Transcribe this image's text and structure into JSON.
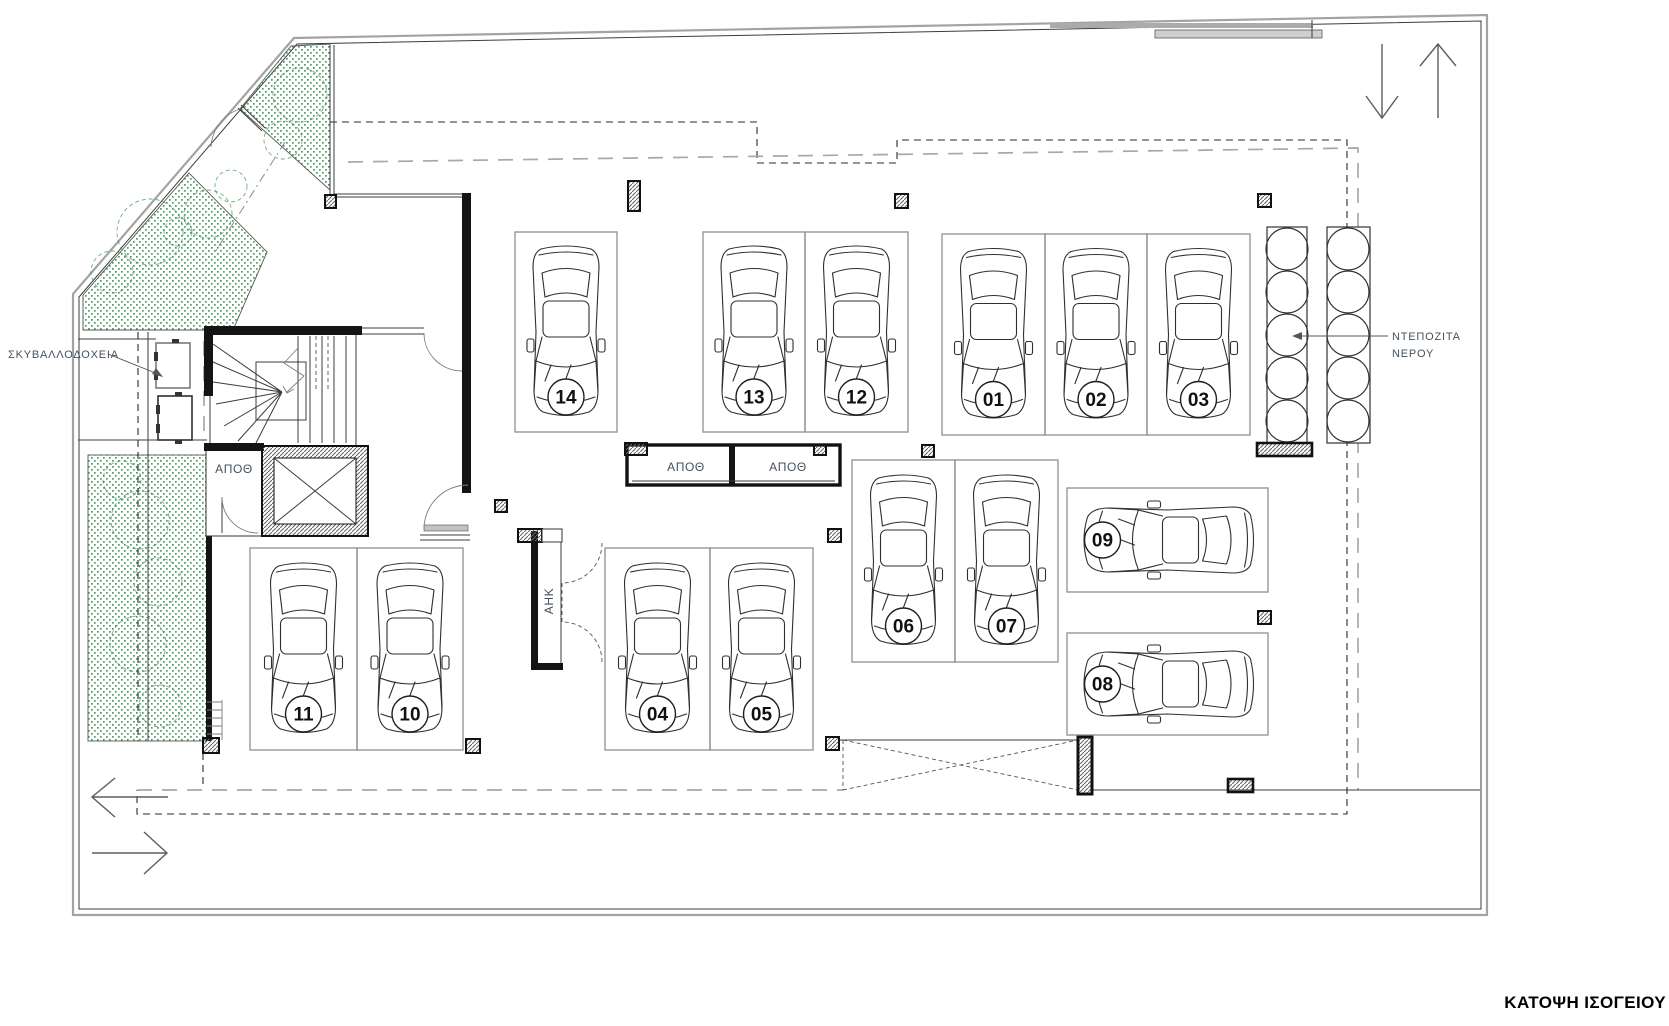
{
  "title": "ΚΑΤΟΨΗ ΙΣΟΓΕΙΟΥ",
  "labels": {
    "garbage_bins": "ΣΚΥΒΑΛΛΟΔΟΧΕΙΑ",
    "storage": "ΑΠΟΘ",
    "electricity_box": "ΑΗΚ",
    "water_tanks_line1": "ΝΤΕΠΟΖΙΤΑ",
    "water_tanks_line2": "ΝΕΡΟΥ"
  },
  "parking_spots": [
    "01",
    "02",
    "03",
    "04",
    "05",
    "06",
    "07",
    "08",
    "09",
    "10",
    "11",
    "12",
    "13",
    "14"
  ],
  "water_tanks": {
    "rows_of_circles": 2,
    "circles_per_row": 5
  },
  "colors": {
    "plant_green": "#2f8c46",
    "label_blue": "#44525f",
    "line_black": "#141414",
    "line_gray": "#a3a3a3"
  }
}
